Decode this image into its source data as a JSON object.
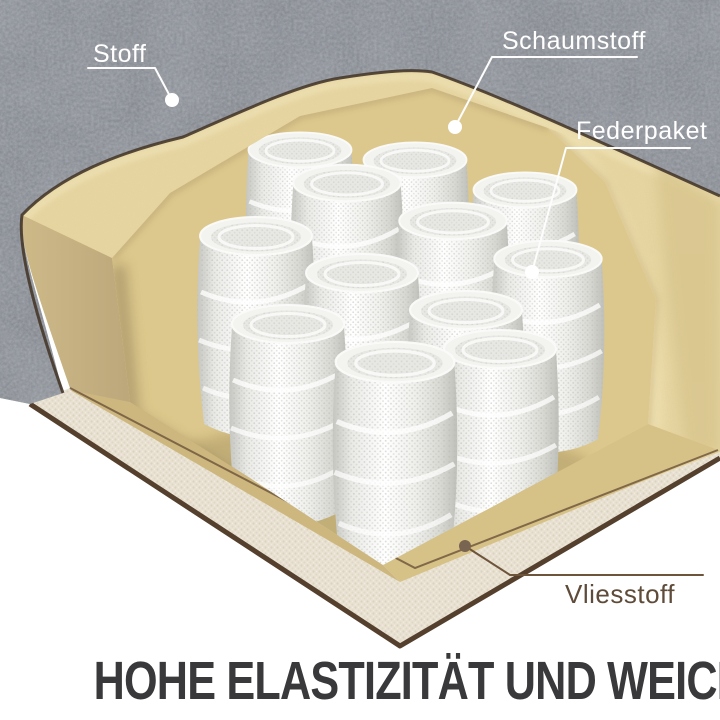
{
  "figure": {
    "heading": "HOHE ELASTIZITÄT UND WEICHHEIT",
    "labels": [
      {
        "id": "stoff",
        "text": "Stoff"
      },
      {
        "id": "schaumstoff",
        "text": "Schaumstoff"
      },
      {
        "id": "federpaket",
        "text": "Federpaket"
      },
      {
        "id": "vliesstoff",
        "text": "Vliesstoff"
      }
    ],
    "colors": {
      "background": "#ffffff",
      "fabric_gray": "#82868d",
      "foam_tan": "#e8d7a2",
      "foam_shadow": "#c9b583",
      "spring_white": "#f4f4f1",
      "vliesstoff_cream": "#eae3d4",
      "edge_brown": "#55402e",
      "heading_text": "#39393b",
      "label_light": "#ffffff",
      "label_dark": "#5e4b39"
    }
  }
}
